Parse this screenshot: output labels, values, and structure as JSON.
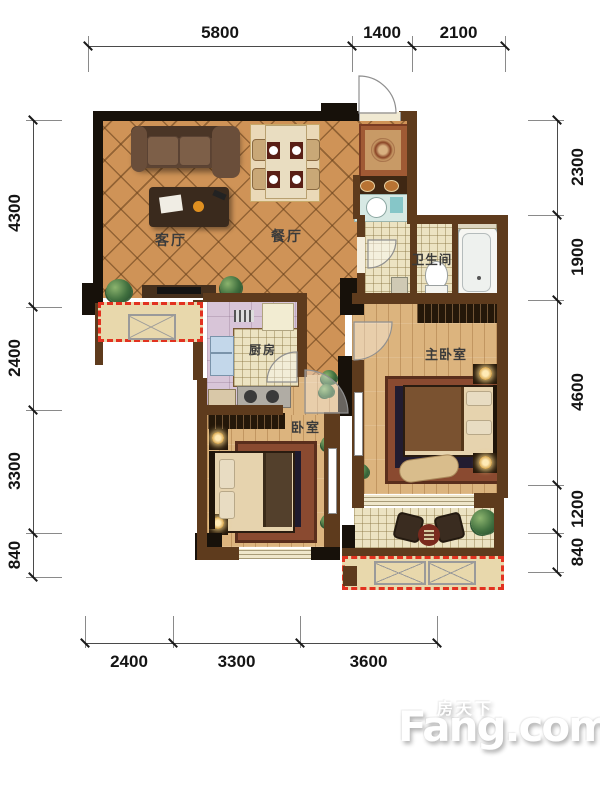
{
  "plan": {
    "dimensions": {
      "top": [
        "5800",
        "1400",
        "2100"
      ],
      "left": [
        "4300",
        "2400",
        "3300",
        "840"
      ],
      "right": [
        "2300",
        "1900",
        "4600",
        "1200",
        "840"
      ],
      "bottom": [
        "2400",
        "3300",
        "3600"
      ]
    },
    "rooms": {
      "living": "客厅",
      "dining": "餐厅",
      "kitchen": "厨房",
      "bathroom": "卫生间",
      "master_bedroom": "主卧室",
      "bedroom": "卧室"
    }
  },
  "watermark": {
    "brand_cn": "房天下",
    "brand_en": "Fang.com"
  },
  "colors": {
    "floor_tile": "#cf9357",
    "floor_wood": "#dcb47e",
    "floor_kitchen": "#d8c5d8",
    "bath_tile": "#ece3c2",
    "wall_dark": "#17110a",
    "wall_brown": "#5e3b1d",
    "bay_fill": "#e8d8ac",
    "dash_red": "#e23220",
    "label_text": "#3b3b3b"
  }
}
